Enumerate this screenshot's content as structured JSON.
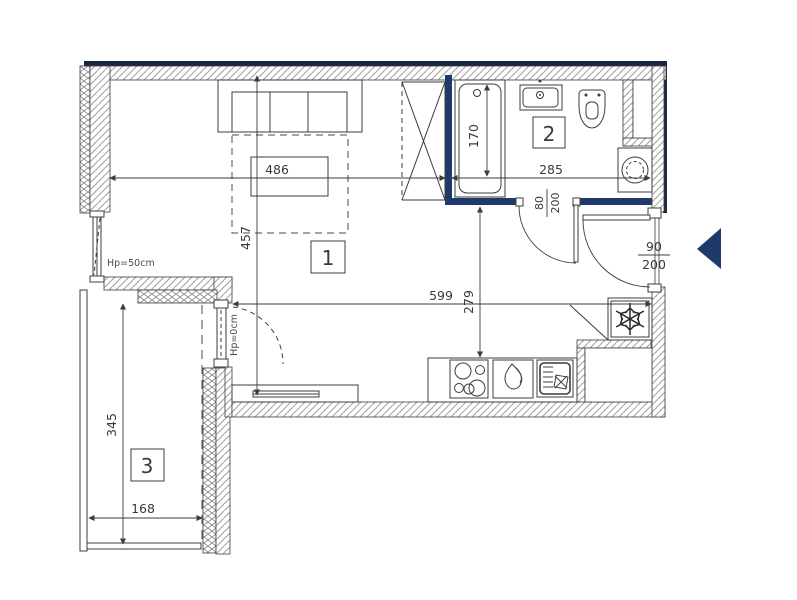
{
  "rooms": {
    "living_room": "1",
    "bathroom": "2",
    "balcony": "3"
  },
  "dims": {
    "d486": "486",
    "d457": "457",
    "d170": "170",
    "d285": "285",
    "d599": "599",
    "d279": "279",
    "d345": "345",
    "d168": "168"
  },
  "doors": {
    "bathroom_w": "80",
    "bathroom_h": "200",
    "entrance_w": "90",
    "entrance_h": "200"
  },
  "windows": {
    "left_window_sill": "Hp=50cm",
    "balcony_door_sill": "Hp=0cm"
  },
  "colors": {
    "accent_navy": "#1e3a6b",
    "wall_edge_dark": "#1a2744",
    "hatch_line": "#a0a0a0",
    "outline": "#3c3c3c",
    "text": "#3a3a3a"
  },
  "icons": {
    "entrance_arrow": "left-pointing-triangle",
    "fridge": "snowflake",
    "cooktop": "four-burner-hob",
    "kitchen_sink": "basin-with-drainer",
    "sink_droplet": "double-droplet",
    "washing_machine": "drum-circle",
    "toilet": "wc",
    "washbasin": "sink-basin",
    "bathtub": "tub-outline",
    "sofa": "three-seat-sofa",
    "wardrobe": "crossed-rectangle",
    "radiator": "slim-bar",
    "door_swing": "quarter-arc"
  }
}
